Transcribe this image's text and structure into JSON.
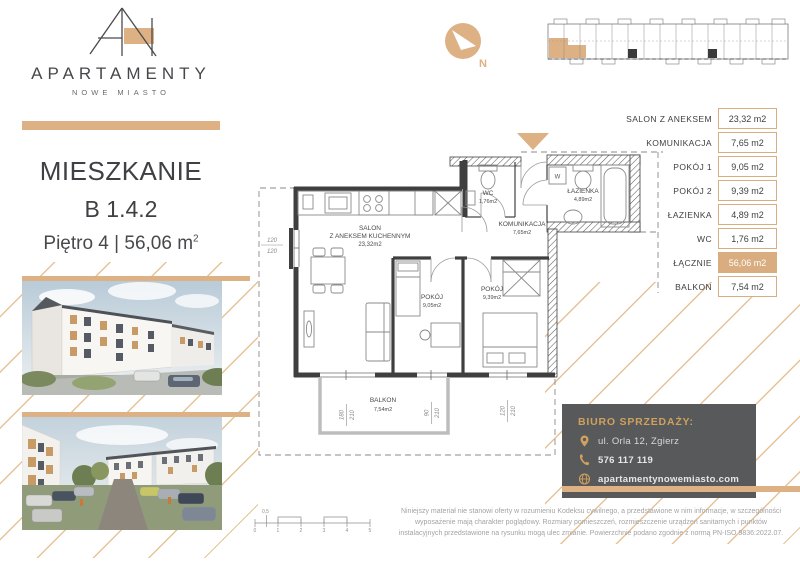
{
  "brand": {
    "name": "APARTAMENTY",
    "subtitle": "NOWE MIASTO"
  },
  "listing": {
    "heading": "MIESZKANIE",
    "unit": "B 1.4.2",
    "floor": "Piętro 4",
    "separator": "|",
    "area": "56,06 m",
    "area_sup": "2"
  },
  "compass": {
    "north": "N"
  },
  "area_table": {
    "rows": [
      {
        "label": "SALON Z ANEKSEM",
        "value": "23,32 m2"
      },
      {
        "label": "KOMUNIKACJA",
        "value": "7,65 m2"
      },
      {
        "label": "POKÓJ 1",
        "value": "9,05 m2"
      },
      {
        "label": "POKÓJ 2",
        "value": "9,39 m2"
      },
      {
        "label": "ŁAZIENKA",
        "value": "4,89 m2"
      },
      {
        "label": "WC",
        "value": "1,76 m2"
      },
      {
        "label": "ŁĄCZNIE",
        "value": "56,06 m2"
      },
      {
        "label": "BALKON",
        "value": "7,54 m2"
      }
    ]
  },
  "plan": {
    "salon_l1": "SALON",
    "salon_l2": "Z ANEKSEM KUCHENNYM",
    "salon_l3": "23,32m2",
    "wc_l1": "WC",
    "wc_l2": "1,76m2",
    "lazienka_l1": "ŁAZIENKA",
    "lazienka_l2": "4,89m2",
    "kom_l1": "KOMUNIKACJA",
    "kom_l2": "7,65m2",
    "pokoj1_l1": "POKÓJ",
    "pokoj1_l2": "9,05m2",
    "pokoj2_l1": "POKÓJ",
    "pokoj2_l2": "9,39m2",
    "balkon_l1": "BALKON",
    "balkon_l2": "7,54m2",
    "washer": "W",
    "dim_left_a": "120",
    "dim_left_b": "120",
    "dim_w1_a": "180",
    "dim_w1_b": "210",
    "dim_w2_a": "90",
    "dim_w2_b": "210",
    "dim_w3_a": "120",
    "dim_w3_b": "210"
  },
  "contact": {
    "title": "BIURO SPRZEDAŻY:",
    "address": "ul. Orla 12, Zgierz",
    "phone": "576 117 119",
    "website": "apartamentynowemiasto.com"
  },
  "disclaimer": "Niniejszy materiał nie stanowi oferty w rozumieniu Kodeksu cywilnego, a przedstawione w nim informacje, w szczególności wyposażenie mają charakter poglądowy. Rozmiary pomieszczeń, rozmieszczenie urządzeń sanitarnych i punktów instalacyjnych przedstawione na rysunku mogą ulec zmianie. Powierzchnie podano zgodnie z normą PN-ISO 9836:2022.07.",
  "scale_bar": {
    "t0": "0",
    "t1": "1",
    "t2": "2",
    "t3": "3",
    "t4": "4",
    "t5": "5",
    "half": "0,5"
  },
  "colors": {
    "accent": "#ddb184",
    "gold_text": "#cfa05e",
    "dark": "#3f4043",
    "panel": "#58595b"
  }
}
